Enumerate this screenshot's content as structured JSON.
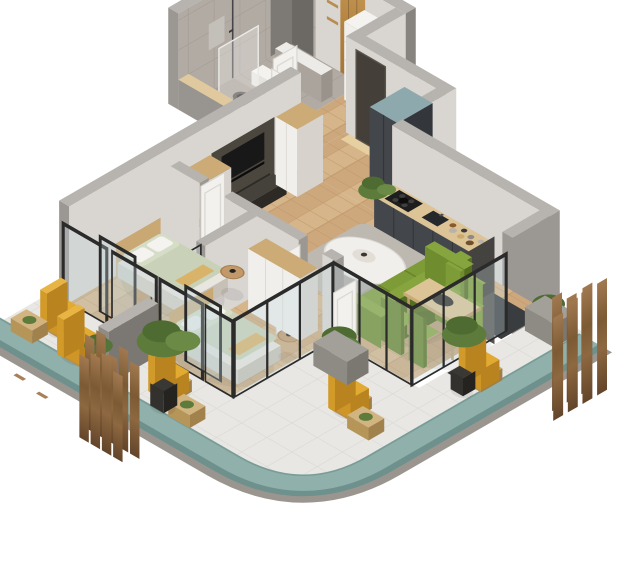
{
  "scene": {
    "type": "isometric-apartment-floorplan-render",
    "background": "#ffffff"
  },
  "colors": {
    "background": "#ffffff",
    "wall_top": "#b7b3ae",
    "wall_light": "#d9d6d2",
    "wall_mid": "#9b9792",
    "wall_dark": "#87837e",
    "bath_tile": "#b2aba3",
    "tile_line": "#a29a92",
    "floor_wood": "#d6b58a",
    "floor_wood_alt": "#cda87c",
    "floor_wood_line": "#c19a6c",
    "balcony_tile": "#e8e7e4",
    "balcony_tile_line": "#d8d7d3",
    "teal_band": "#8fb0ab",
    "teal_band_dark": "#6e918d",
    "slab_gray": "#9a968f",
    "kitchen_charcoal": "#43474b",
    "kitchen_charcoal_dark": "#33373b",
    "counter_wood": "#dcc496",
    "steel_blue": "#8ea9ad",
    "olive_green": "#7d9b37",
    "olive_dark": "#67832a",
    "olive_deep": "#556e20",
    "sage_bedding": "#c9d2b8",
    "sage_light": "#d6ddc6",
    "mustard": "#e2aa31",
    "mustard_dark": "#c28e23",
    "chair_wood": "#c8a668",
    "screen_wood": "#8a6540",
    "screen_wood_dark": "#5c4225",
    "screen_wood_light": "#a57c4e",
    "white_furniture": "#f0efec",
    "wood_furniture": "#cdab77",
    "entry_door": "#453f39",
    "media_panel": "#4b463e",
    "tv_black": "#181818",
    "rug": "#bdb9b1",
    "glass_tint": "#c5d6d9",
    "frame_black": "#2b2b2b",
    "plant_green": "#5d7b3a",
    "plant_green_dark": "#4e6c31",
    "pot_black": "#33312e"
  },
  "rooms": [
    {
      "name": "bathroom",
      "items": [
        "shower-rail",
        "glass-shower-screen",
        "toilet",
        "dark-washbasin",
        "vanity-half-wall",
        "tiled-walls"
      ]
    },
    {
      "name": "entry-hall",
      "items": [
        "wood-wardrobe-panel",
        "wall-shelves",
        "washing-machine-column",
        "white-door",
        "entry-door",
        "wood-threshold"
      ]
    },
    {
      "name": "corridor",
      "items": [
        "herringbone-floor"
      ]
    },
    {
      "name": "kitchen",
      "items": [
        "tall-charcoal-cabinet",
        "counter-run",
        "gas-cooktop",
        "sink",
        "bottles-and-jars",
        "potted-plant"
      ]
    },
    {
      "name": "living-room",
      "items": [
        "tv-media-wall",
        "tv",
        "speakers",
        "white-cabinet-a",
        "white-cabinet-b",
        "round-side-table",
        "gray-rug",
        "oval-coffee-table",
        "green-sofa",
        "dining-table",
        "dining-chairs-x4"
      ]
    },
    {
      "name": "bedroom-1",
      "items": [
        "double-bed",
        "headboard",
        "pillows",
        "round-side-table",
        "white-door"
      ]
    },
    {
      "name": "bedroom-2",
      "items": [
        "double-bed",
        "headboard",
        "pillows",
        "round-side-table",
        "white-wardrobe",
        "white-door"
      ]
    },
    {
      "name": "balcony",
      "items": [
        "glass-sliding-walls",
        "privacy-divider",
        "yellow-armchairs",
        "slatted-coffee-tables",
        "planter-boxes",
        "tall-potted-plants",
        "teal-edge-band",
        "tile-floor"
      ]
    },
    {
      "name": "exterior",
      "items": [
        "wood-slat-screen-left",
        "wood-slat-screen-right"
      ]
    }
  ]
}
